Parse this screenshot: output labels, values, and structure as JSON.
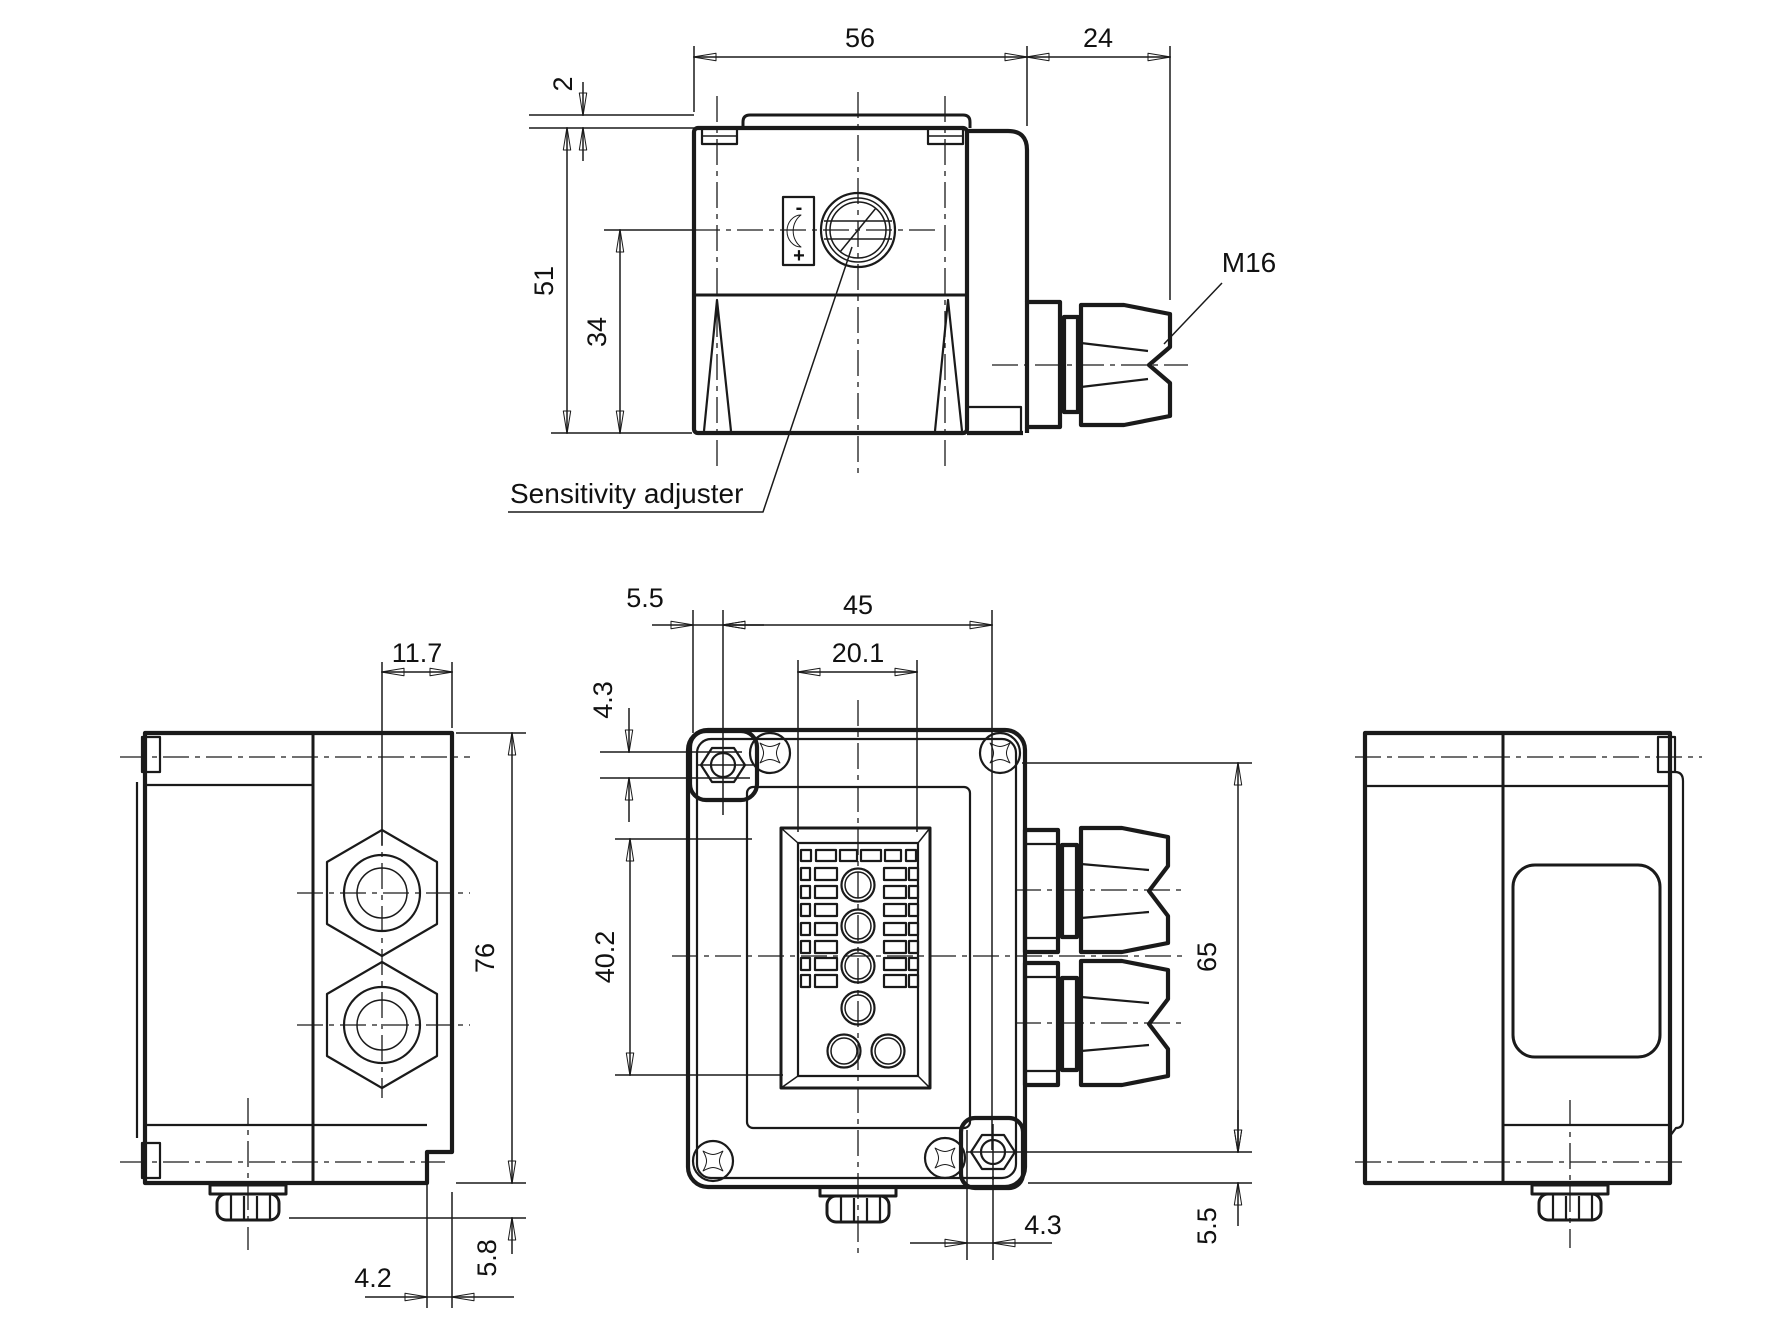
{
  "page": {
    "type": "technical-dimensional-drawing",
    "background": "#ffffff",
    "ink": "#1a1a1a"
  },
  "views": {
    "top": {
      "dims": {
        "body_width": "56",
        "gland_length": "24",
        "lid_lip": "2",
        "body_depth": "51",
        "adjuster_offset": "34"
      },
      "labels": {
        "thread_size": "M16",
        "adjuster_callout": "Sensitivity adjuster",
        "adjuster_minus": "-",
        "adjuster_plus": "+"
      }
    },
    "front": {
      "dims": {
        "mount_hole_edge_offset": "5.5",
        "mount_hole_spacing": "45",
        "label_panel_width": "20.1",
        "mount_hole_top_offset": "4.3",
        "label_panel_height": "40.2",
        "mount_hole_vertical_spacing": "65",
        "mount_hole_bottom_offset": "4.3",
        "mount_hole_bottom_edge_offset": "5.5"
      }
    },
    "left": {
      "dims": {
        "gland_center_to_edge": "11.7",
        "housing_height": "76",
        "foot_step_width": "4.2",
        "knob_protrusion": "5.8"
      }
    }
  }
}
